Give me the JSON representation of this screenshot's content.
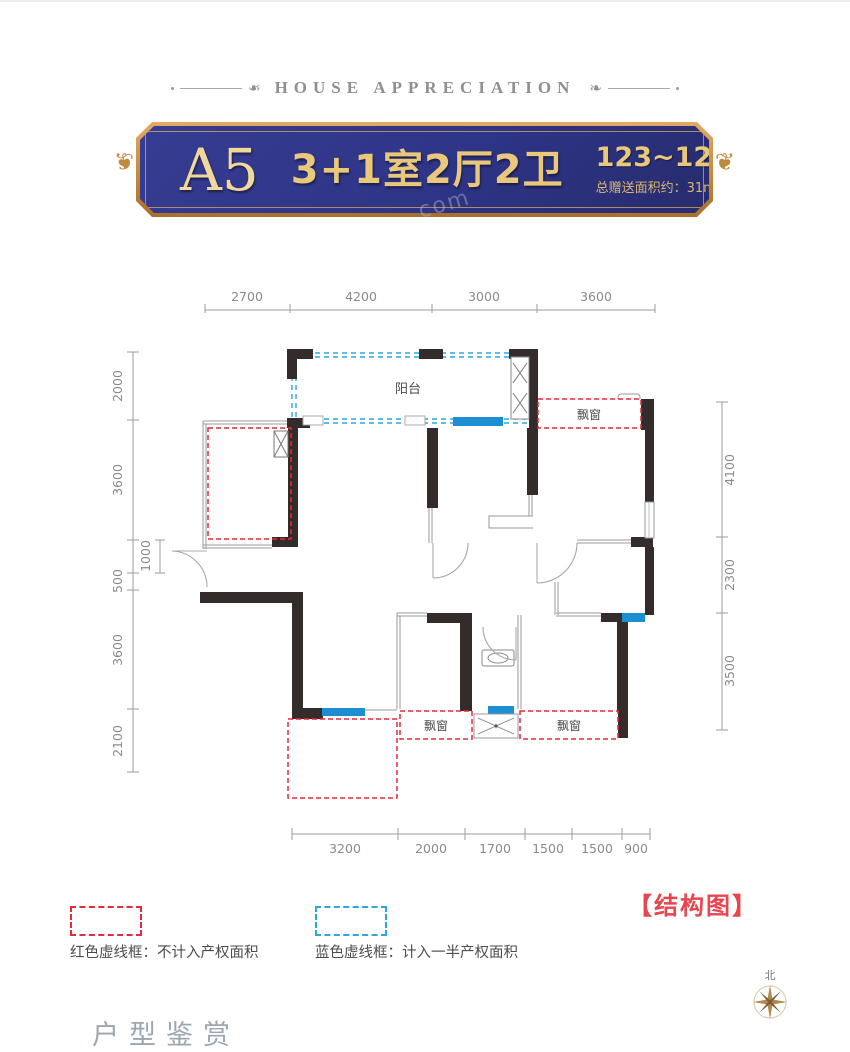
{
  "header": {
    "title": "HOUSE APPRECIATION"
  },
  "banner": {
    "unit": "A5",
    "layout": "3+1室2厅2卫",
    "area": "123~128m²",
    "bonus": "总赠送面积约：31m²"
  },
  "watermark": "com",
  "plan": {
    "labels": {
      "balcony": "阳台",
      "bay_window": "飘窗"
    },
    "dims_top": [
      "2700",
      "4200",
      "3000",
      "3600"
    ],
    "dims_left": [
      "2000",
      "3600",
      "1000",
      "500",
      "3600",
      "2100"
    ],
    "dims_right": [
      "4100",
      "2300",
      "3500"
    ],
    "dims_bottom": [
      "3200",
      "2000",
      "1700",
      "1500",
      "1500",
      "900"
    ]
  },
  "legend": {
    "red_label": "红色虚线框：不计入产权面积",
    "blue_label": "蓝色虚线框：计入一半产权面积",
    "title": "【结构图】"
  },
  "colors": {
    "banner_navy": "#2e3486",
    "banner_gold": "#c9913f",
    "red_dash": "#e62a39",
    "blue_dash": "#2aa7dd",
    "blue_solid": "#1d8fd1",
    "wall": "#332c2a"
  },
  "compass": {
    "north": "北"
  },
  "footer": {
    "partial_text": "户型鉴赏"
  }
}
